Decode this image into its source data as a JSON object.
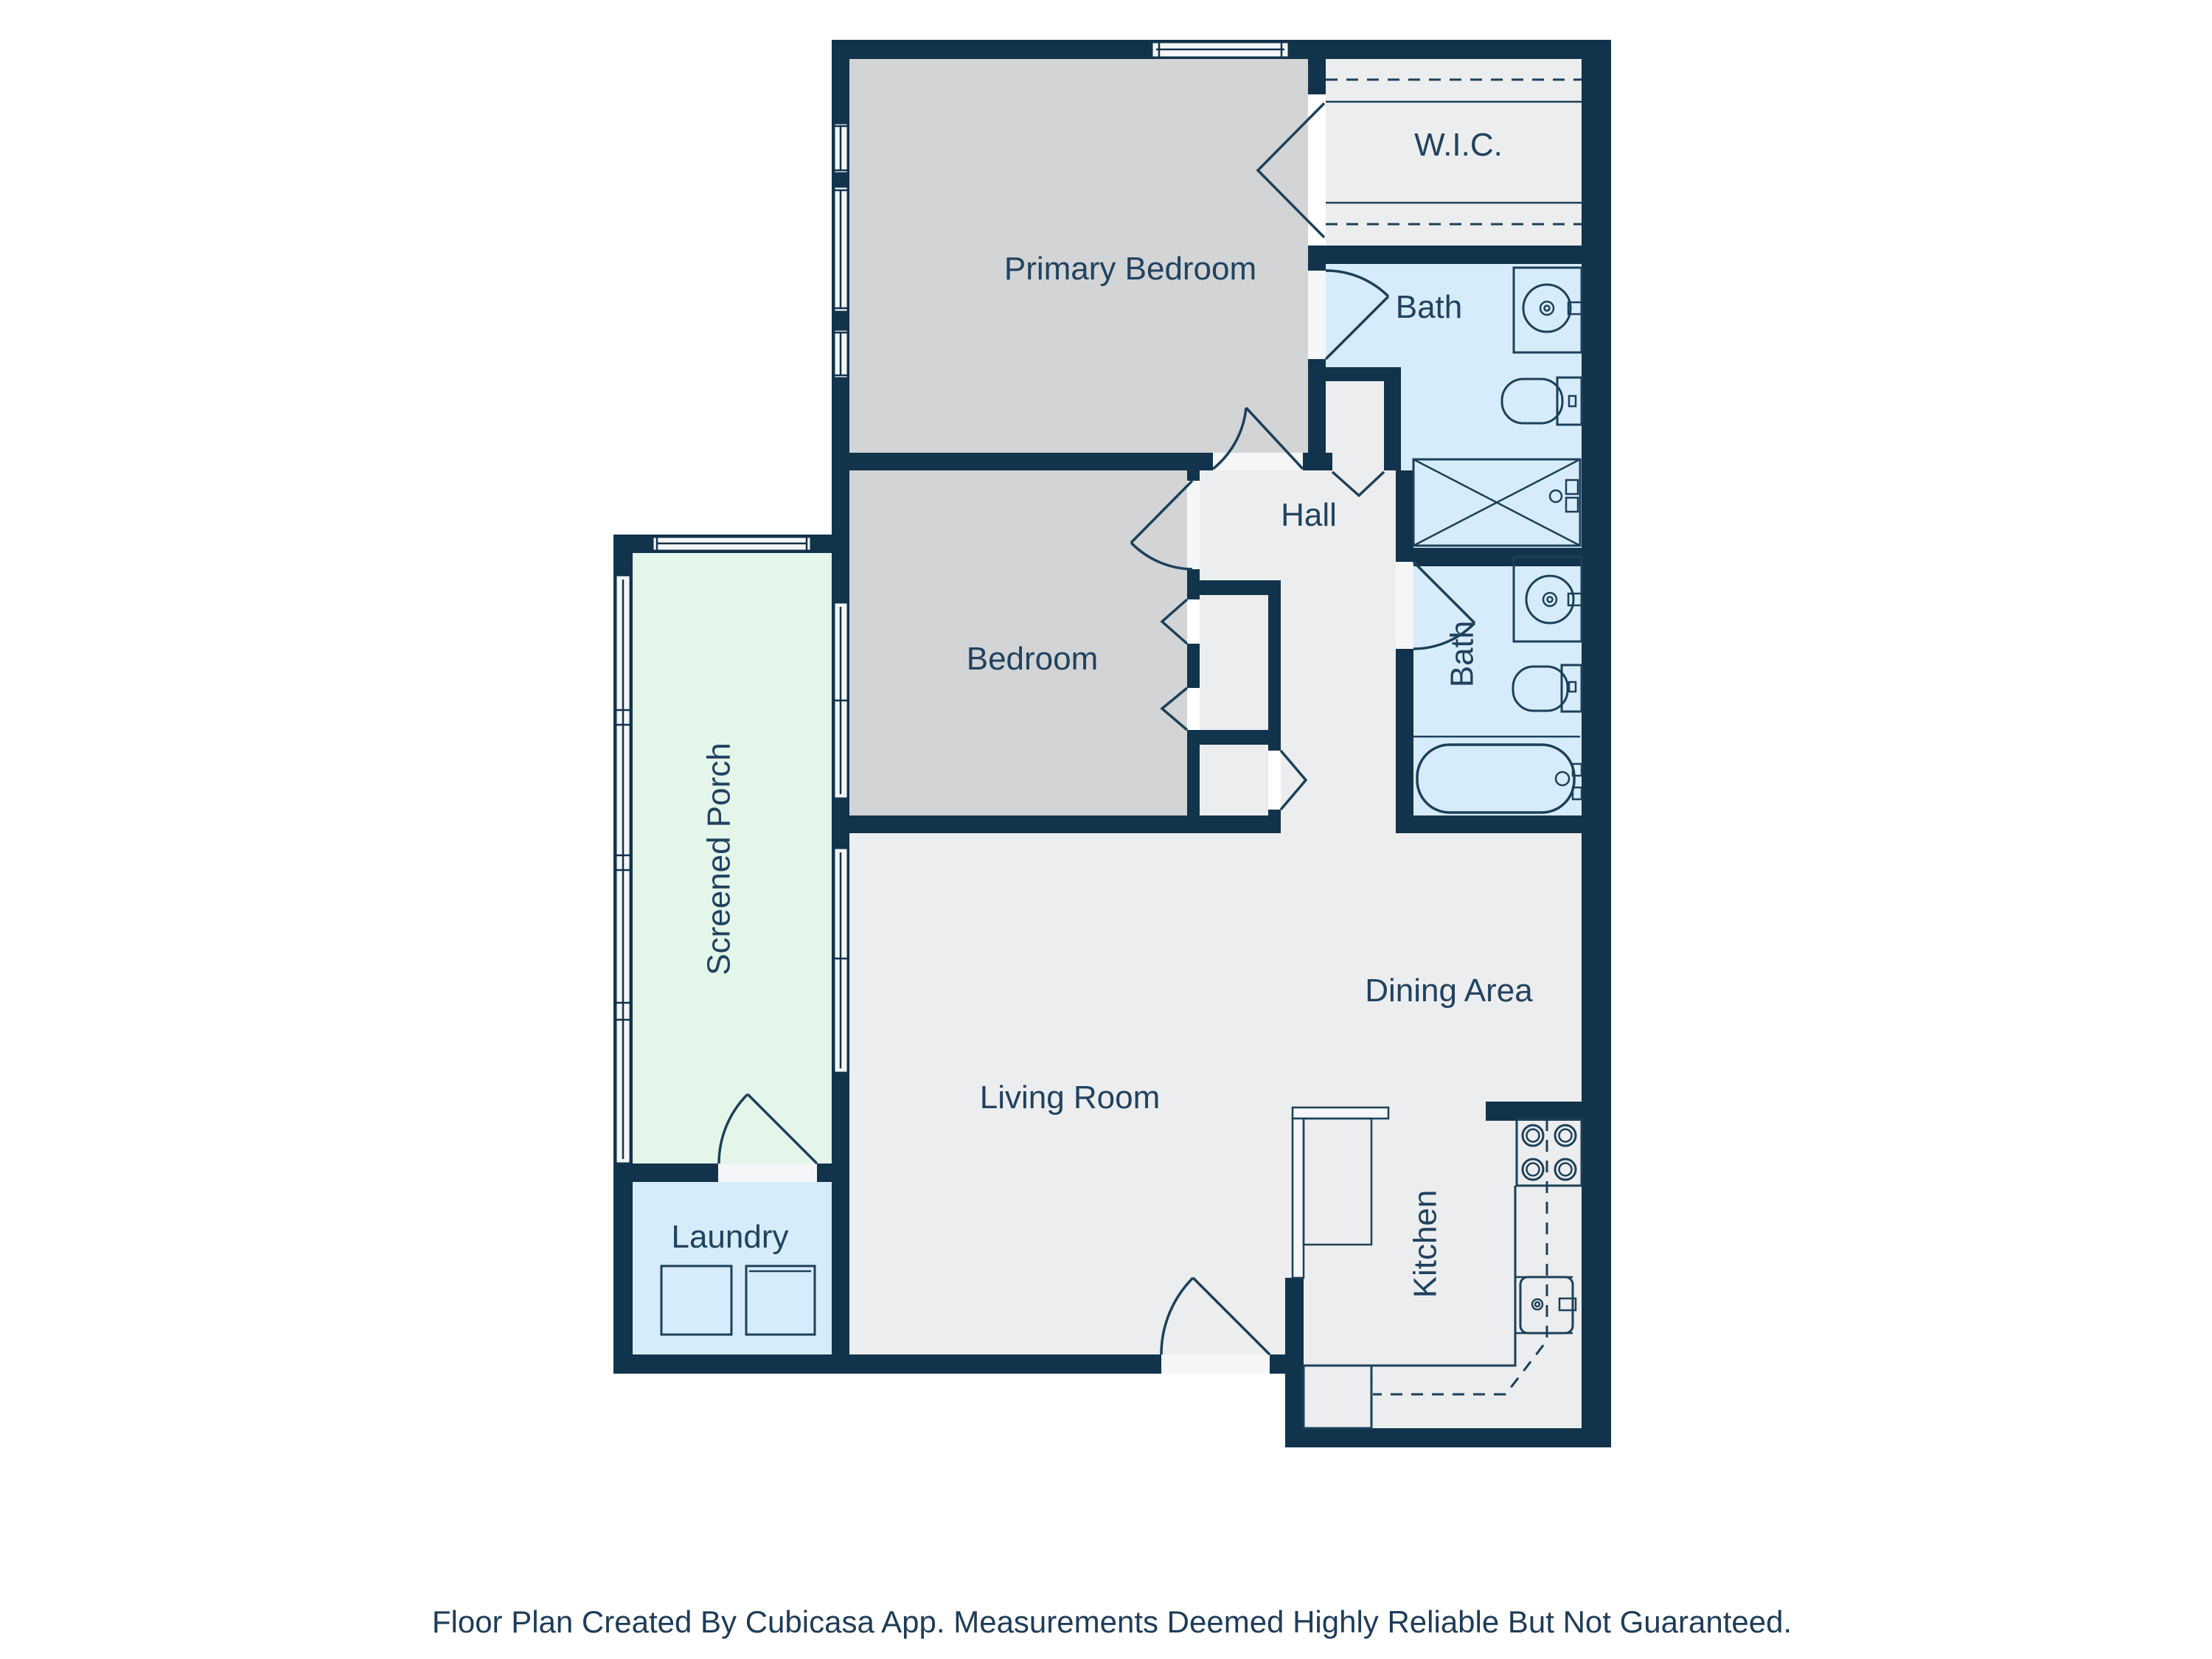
{
  "palette": {
    "wall": "#12334C",
    "floor": "#ECEDEE",
    "bedroom_floor": "#D2D4D5",
    "bath_floor": "#D7ECFA",
    "porch_floor": "#E4F5EA",
    "window_fill": "#F4F6F8",
    "fixture_line": "#1C4059",
    "label_text": "#21425F",
    "background": "#FFFFFF"
  },
  "rooms": {
    "primary_bedroom": {
      "label": "Primary Bedroom"
    },
    "wic": {
      "label": "W.I.C."
    },
    "bath_top": {
      "label": "Bath"
    },
    "hall": {
      "label": "Hall"
    },
    "bedroom": {
      "label": "Bedroom"
    },
    "bath_right": {
      "label": "Bath"
    },
    "screened_porch": {
      "label": "Screened Porch"
    },
    "dining_area": {
      "label": "Dining Area"
    },
    "living_room": {
      "label": "Living Room"
    },
    "laundry": {
      "label": "Laundry"
    },
    "kitchen": {
      "label": "Kitchen"
    }
  },
  "fixtures": [
    "sink",
    "toilet",
    "shower",
    "bathtub",
    "washer",
    "dryer",
    "stove",
    "kitchen-sink",
    "counter",
    "peninsula"
  ],
  "footer": {
    "disclaimer": "Floor Plan Created By Cubicasa App. Measurements Deemed Highly Reliable But Not Guaranteed."
  }
}
